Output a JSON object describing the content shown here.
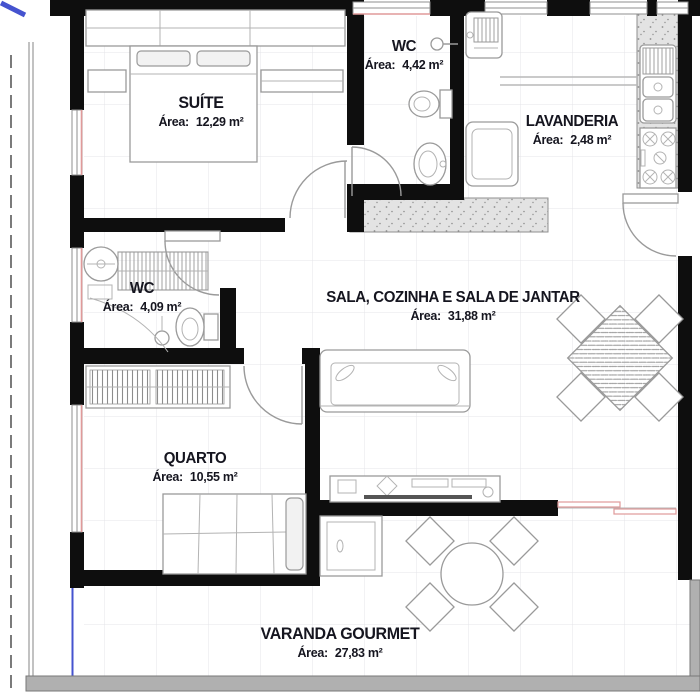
{
  "plan": {
    "rooms": [
      {
        "id": "suite",
        "name": "SUÍTE",
        "area_label": "Área:",
        "area_value": "12,29 m²"
      },
      {
        "id": "wc1",
        "name": "WC",
        "area_label": "Área:",
        "area_value": "4,42 m²"
      },
      {
        "id": "lavanderia",
        "name": "LAVANDERIA",
        "area_label": "Área:",
        "area_value": "2,48 m²"
      },
      {
        "id": "wc2",
        "name": "WC",
        "area_label": "Área:",
        "area_value": "4,09 m²"
      },
      {
        "id": "sala",
        "name": "SALA, COZINHA E SALA DE JANTAR",
        "area_label": "Área:",
        "area_value": "31,88 m²"
      },
      {
        "id": "quarto",
        "name": "QUARTO",
        "area_label": "Área:",
        "area_value": "10,55 m²"
      },
      {
        "id": "varanda",
        "name": "VARANDA GOURMET",
        "area_label": "Área:",
        "area_value": "27,83 m²"
      }
    ],
    "colors": {
      "wall": "#0e0e0e",
      "label": "#15151f",
      "furniture": "#9a9a9a",
      "window_accent": "#e09a9a",
      "counter": "#e3e3e3",
      "boundary_blue": "#4553cf",
      "band_gray": "#b0b0b0"
    }
  }
}
